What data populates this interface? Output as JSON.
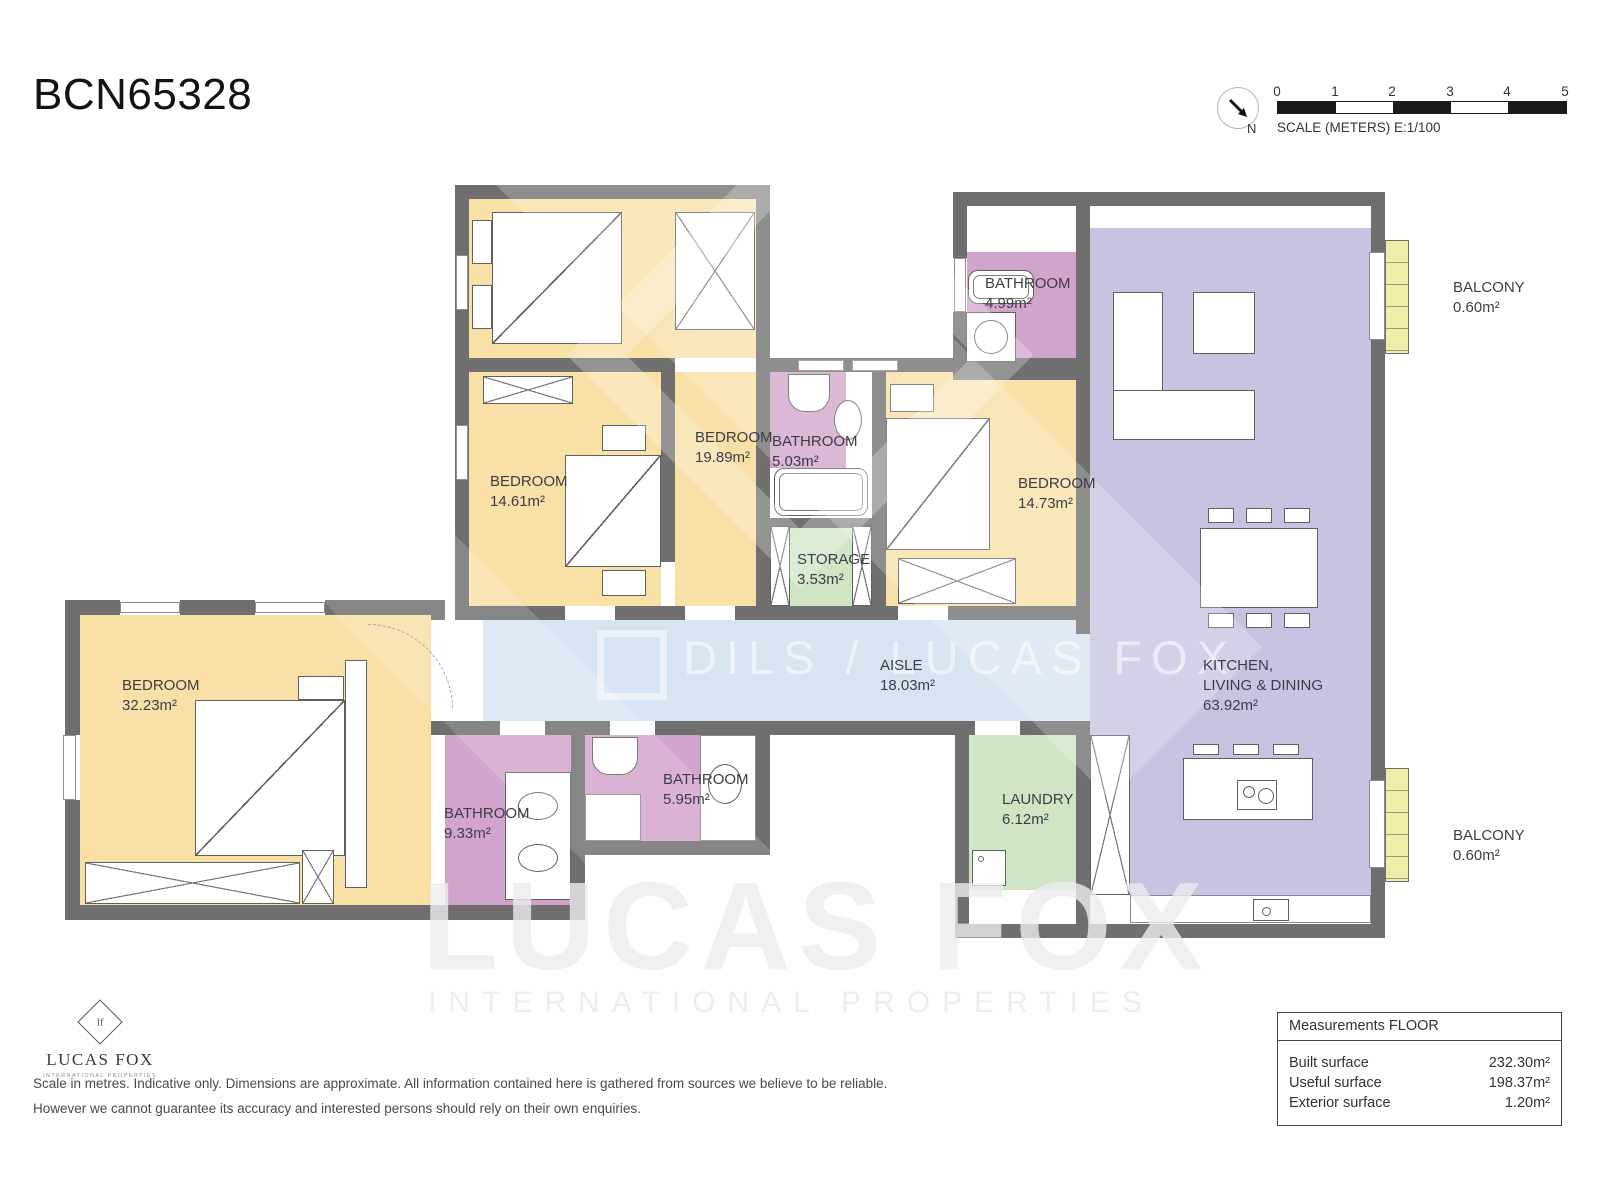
{
  "title": "BCN65328",
  "compass": {
    "north": "N"
  },
  "scalebar": {
    "ticks": [
      "0",
      "1",
      "2",
      "3",
      "4",
      "5"
    ],
    "caption": "SCALE (METERS) E:1/100"
  },
  "rooms": {
    "bedroom_top": {
      "name": "BEDROOM",
      "area": "19.89m²"
    },
    "bedroom_mid": {
      "name": "BEDROOM",
      "area": "14.61m²"
    },
    "bathroom_503": {
      "name": "BATHROOM",
      "area": "5.03m²"
    },
    "storage": {
      "name": "STORAGE",
      "area": "3.53m²"
    },
    "bedroom_right": {
      "name": "BEDROOM",
      "area": "14.73m²"
    },
    "bathroom_499": {
      "name": "BATHROOM",
      "area": "4.99m²"
    },
    "kitchen": {
      "line1": "KITCHEN,",
      "line2": "LIVING & DINING",
      "area": "63.92m²"
    },
    "aisle": {
      "name": "AISLE",
      "area": "18.03m²"
    },
    "bedroom_master": {
      "name": "BEDROOM",
      "area": "32.23m²"
    },
    "bathroom_933": {
      "name": "BATHROOM",
      "area": "9.33m²"
    },
    "bathroom_595": {
      "name": "BATHROOM",
      "area": "5.95m²"
    },
    "laundry": {
      "name": "LAUNDRY",
      "area": "6.12m²"
    },
    "balcony_top": {
      "name": "BALCONY",
      "area": "0.60m²"
    },
    "balcony_bottom": {
      "name": "BALCONY",
      "area": "0.60m²"
    }
  },
  "watermark": {
    "center_text": "DILS / LUCAS FOX",
    "big": "LUCAS FOX",
    "big_sub": "INTERNATIONAL PROPERTIES"
  },
  "brand": {
    "monogram": "lf",
    "name": "LUCAS FOX",
    "sub": "INTERNATIONAL PROPERTIES"
  },
  "disclaimer": {
    "line1": "Scale in metres. Indicative only. Dimensions are approximate. All information contained here is gathered from sources we believe to be reliable.",
    "line2": "However we cannot guarantee its accuracy and interested persons should rely on their own enquiries."
  },
  "measurements": {
    "header": "Measurements FLOOR",
    "rows": [
      {
        "label": "Built surface",
        "value": "232.30m²"
      },
      {
        "label": "Useful surface",
        "value": "198.37m²"
      },
      {
        "label": "Exterior surface",
        "value": "1.20m²"
      }
    ]
  },
  "colors": {
    "bedroom": "#f8e0a6",
    "bathroom": "#d2a4cc",
    "living": "#c7c4e2",
    "aisle": "#d7e5f3",
    "utility": "#cfe6c4",
    "balcony": "#f2eda9",
    "wall": "#6f6f6f"
  }
}
